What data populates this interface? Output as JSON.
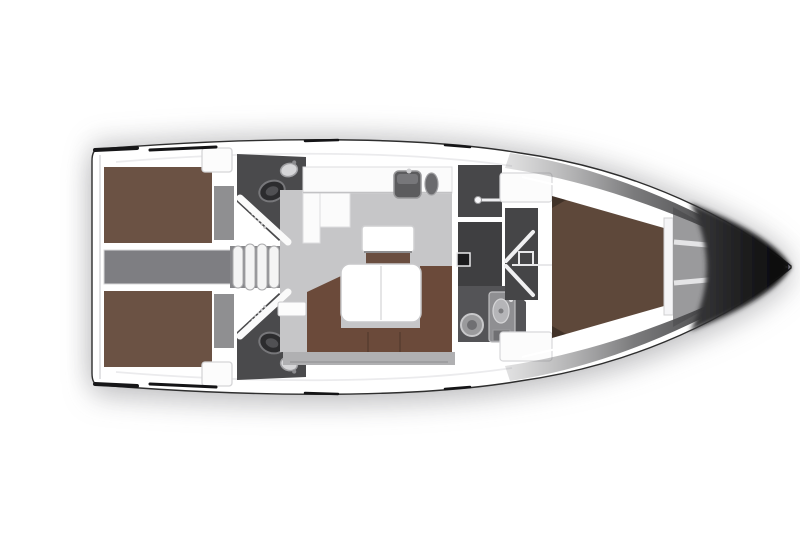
{
  "meta": {
    "type": "yacht-interior-floor-plan",
    "orientation": "bow-right",
    "visible_text": "none"
  },
  "colors": {
    "background": "#ffffff",
    "hull_white": "#ffffff",
    "outline_dark": "#2e2e2e",
    "trim_black": "#161618",
    "deck_seam": "#ebebed",
    "berth_brown": "#6b5244",
    "forward_berth": "#5e483a",
    "sofa_brown": "#6b4a3a",
    "seat_brown": "#6a4e40",
    "table_white": "#ffffff",
    "counter_white": "#fbfbfb",
    "locker_white": "#fcfcfc",
    "salon_floor": "#c6c6c8",
    "floor_strip": "#b0b0b2",
    "corridor_gray": "#7e7e82",
    "steps_shadow": "#87878a",
    "step_white": "#f4f4f4",
    "foot_gray": "#8f8f91",
    "head_dark": "#4a4a4c",
    "shower_dark": "#474749",
    "tech_dark": "#3f3f41",
    "passage_dark": "#454547",
    "bath_dark": "#545457",
    "sink_dark": "#5c5c5e",
    "anchor_gray": "#9a9a9c",
    "bow_dark": "#0c0c0c"
  },
  "areas": [
    {
      "id": "transom",
      "label": "stern transom"
    },
    {
      "id": "aft-cabin-port",
      "label": "port aft double cabin"
    },
    {
      "id": "aft-cabin-starboard",
      "label": "starboard aft double cabin"
    },
    {
      "id": "aft-head-port",
      "label": "port aft head with toilet and sink"
    },
    {
      "id": "aft-head-starboard",
      "label": "starboard aft head with toilet and sink"
    },
    {
      "id": "engine-compartment",
      "label": "engine compartment under cockpit"
    },
    {
      "id": "companionway-steps",
      "label": "companionway steps"
    },
    {
      "id": "galley",
      "label": "L-shaped galley with double sink"
    },
    {
      "id": "chart-seat",
      "label": "navigation seat and chart table"
    },
    {
      "id": "salon",
      "label": "salon with U-shaped sofa and folding table"
    },
    {
      "id": "shower-room",
      "label": "separate shower compartment"
    },
    {
      "id": "technical-locker",
      "label": "technical / wet locker"
    },
    {
      "id": "forward-head",
      "label": "forward head with toilet and washbasin"
    },
    {
      "id": "forward-cabin",
      "label": "forward V-berth cabin"
    },
    {
      "id": "anchor-locker",
      "label": "anchor locker with struts"
    },
    {
      "id": "bow",
      "label": "bow"
    }
  ]
}
